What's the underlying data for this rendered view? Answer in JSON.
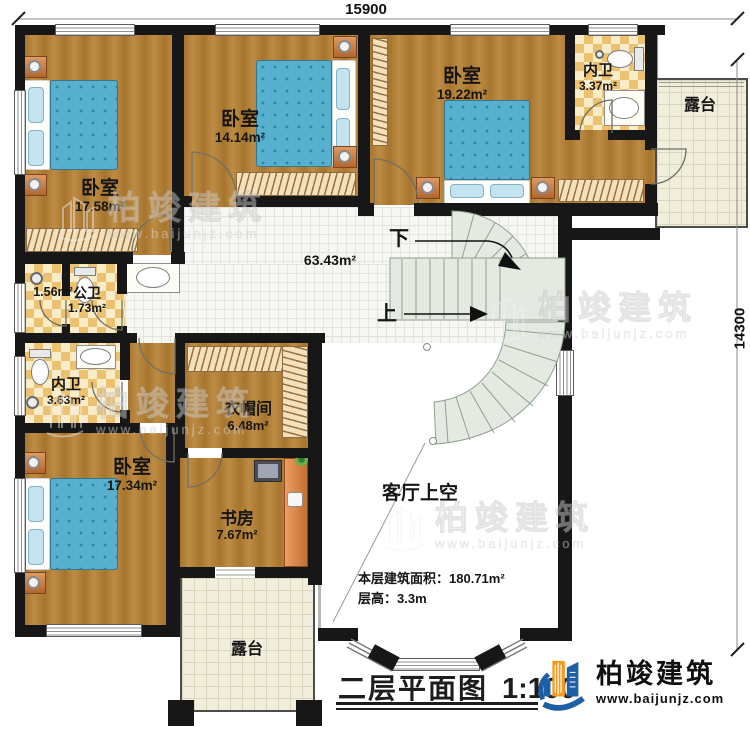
{
  "dims": {
    "width_label": "15900",
    "height_label": "14300"
  },
  "rooms": {
    "bedroom_tl": {
      "name": "卧室",
      "area": "17.58m²"
    },
    "bedroom_tm": {
      "name": "卧室",
      "area": "14.14m²"
    },
    "bedroom_tr": {
      "name": "卧室",
      "area": "19.22m²"
    },
    "ensuite_tr": {
      "name": "内卫",
      "area": "3.37m²"
    },
    "terrace_tr": {
      "name": "露台"
    },
    "hallway": {
      "area": "63.43m²"
    },
    "shower_closet": {
      "area": "1.56m²"
    },
    "public_bath": {
      "name": "公卫",
      "area": "1.73m²"
    },
    "ensuite_ml": {
      "name": "内卫",
      "area": "3.63m²"
    },
    "cloakroom": {
      "name": "衣帽间",
      "area": "6.48m²"
    },
    "bedroom_bl": {
      "name": "卧室",
      "area": "17.34m²"
    },
    "study": {
      "name": "书房",
      "area": "7.67m²"
    },
    "living_void": {
      "name": "客厅上空"
    },
    "terrace_bottom": {
      "name": "露台"
    }
  },
  "stairs": {
    "down_label": "下",
    "up_label": "上"
  },
  "notes": {
    "floor_area_label": "本层建筑面积：",
    "floor_area_value": "180.71m²",
    "floor_height_label": "层高：",
    "floor_height_value": "3.3m"
  },
  "title": {
    "name": "二层平面图",
    "scale": "1:100"
  },
  "brand": {
    "name": "柏竣建筑",
    "website": "www.baijunjz.com"
  },
  "colors": {
    "wall": "#171717",
    "wood_floor": "#ad7a33",
    "tile_checker": "#ecc170",
    "stair": "#e4eae2",
    "bed_blue": "#57b1ce",
    "brand_blue": "#1c5fa5",
    "brand_orange": "#f39c1f"
  }
}
